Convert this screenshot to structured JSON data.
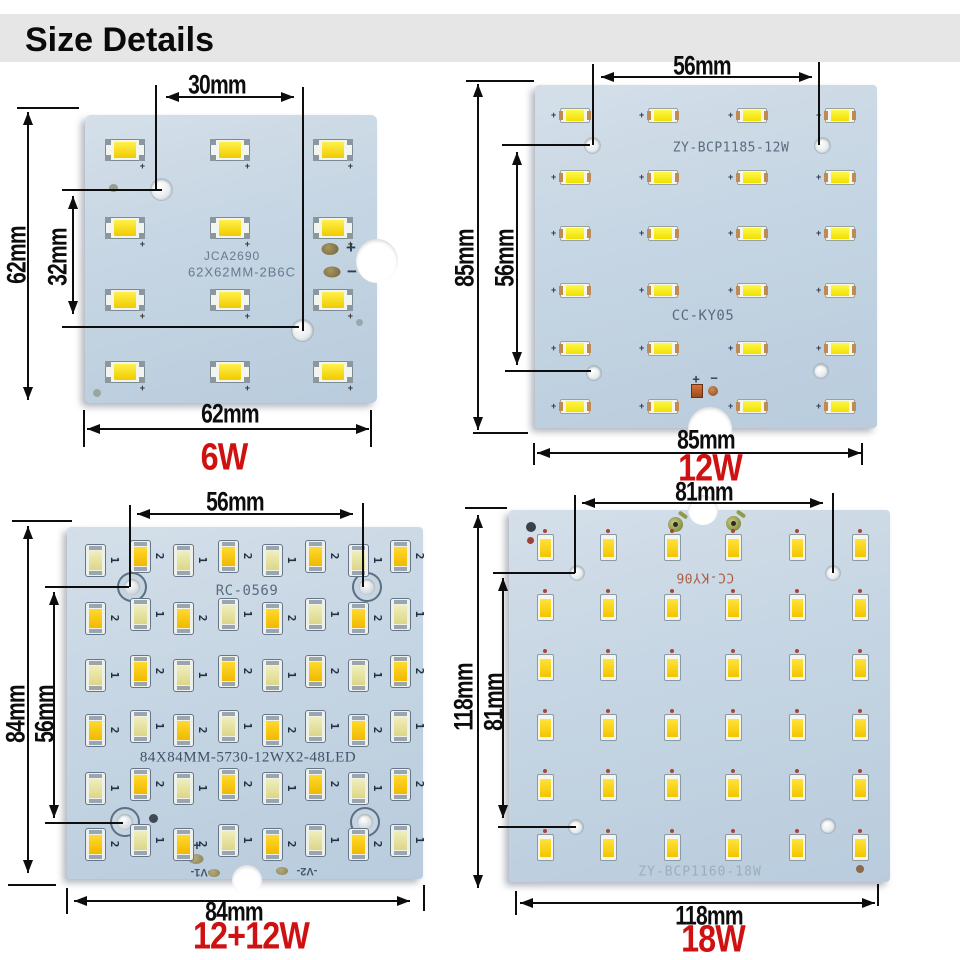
{
  "header": {
    "title": "Size Details"
  },
  "colors": {
    "accent_red": "#cf1111",
    "board_blue": "#c5d5e3",
    "led_yellow": "#f0cb00",
    "dimension_black": "#0d0d0d"
  },
  "panels": [
    {
      "id": "6w",
      "wattage": "6W",
      "dim_top": "30mm",
      "dim_side": "62mm",
      "dim_inner": "32mm",
      "dim_bottom": "62mm",
      "board_code": "JCA2690",
      "board_code2": "62X62MM-2B6C",
      "plus": "+",
      "minus": "−",
      "leds": {
        "rows": 4,
        "cols": 3,
        "count": 12
      }
    },
    {
      "id": "12w",
      "wattage": "12W",
      "dim_top": "56mm",
      "dim_side": "85mm",
      "dim_inner": "56mm",
      "dim_bottom": "85mm",
      "board_code": "ZY-BCP1185-12W",
      "board_code2": "CC-KY05",
      "plus": "+",
      "minus": "−",
      "leds": {
        "rows": 6,
        "cols": 4,
        "count": 24
      }
    },
    {
      "id": "12plus12w",
      "wattage": "12+12W",
      "dim_top": "56mm",
      "dim_side": "84mm",
      "dim_inner": "56mm",
      "dim_bottom": "84mm",
      "board_code": "RC-0569",
      "board_code2": "84X84MM-5730-12WX2-48LED",
      "plus": "+",
      "v1_label": "-V1-",
      "v2_label": "-V2-",
      "led_digits": [
        "1",
        "2"
      ],
      "leds": {
        "rows": 6,
        "cols": 8,
        "count": 48
      }
    },
    {
      "id": "18w",
      "wattage": "18W",
      "dim_top": "81mm",
      "dim_side": "118mm",
      "dim_inner": "81mm",
      "dim_bottom": "118mm",
      "board_code": "CC-KY06",
      "board_code2": "ZY-BCP1160-18W",
      "leds": {
        "rows": 6,
        "cols": 6,
        "count": 36
      }
    }
  ]
}
